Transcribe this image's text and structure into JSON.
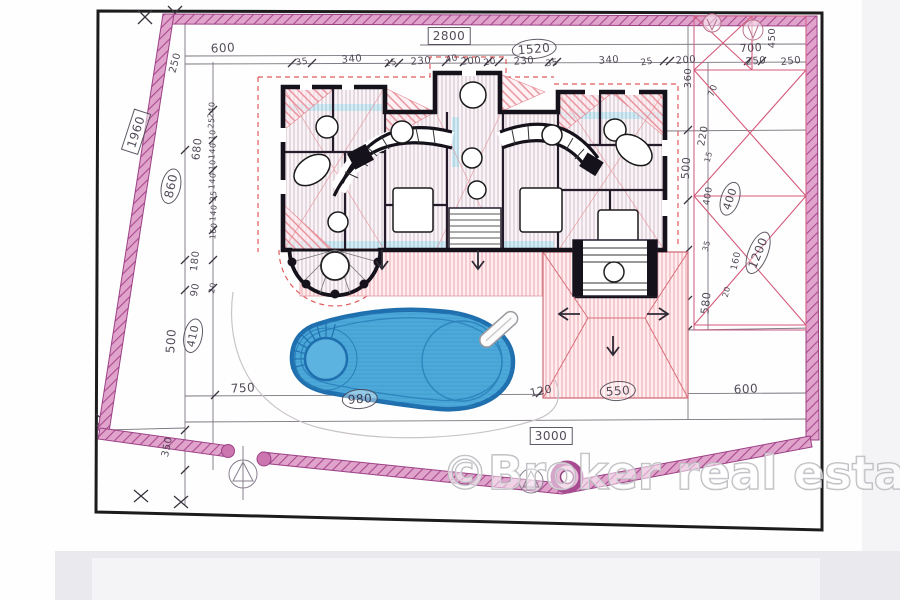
{
  "watermark": {
    "text": "©Broker real estate"
  },
  "colors": {
    "boundary_pink": "#b05898",
    "boundary_fill": "#e2a6cd",
    "pool_blue": "#4da9da",
    "pool_edge": "#1f6fae",
    "roof_red": "#e8909a",
    "wall_black": "#16121c",
    "pencil": "#4a4350",
    "paper": "#ffffff",
    "footer_gray": "#e9e9ee"
  },
  "plan": {
    "symbols": [
      "survey-marker",
      "well-ring",
      "gate-posts",
      "pergola-cross-bracing",
      "pool-ladder",
      "spa-steps",
      "direction-arrows",
      "entrance-stairs",
      "rotunda-terrace"
    ],
    "labels": [
      {
        "text": "600",
        "x": 223,
        "y": 48,
        "rot": -3,
        "size": 12
      },
      {
        "text": "2800",
        "x": 449,
        "y": 36,
        "rot": 0,
        "deco": "box",
        "size": 12
      },
      {
        "text": "1520",
        "x": 534,
        "y": 49,
        "rot": -5,
        "deco": "circle",
        "size": 12
      },
      {
        "text": "35",
        "x": 302,
        "y": 63,
        "rot": -8,
        "size": 9
      },
      {
        "text": "340",
        "x": 352,
        "y": 60,
        "rot": -5,
        "size": 10
      },
      {
        "text": "25",
        "x": 391,
        "y": 64,
        "rot": -10,
        "size": 9
      },
      {
        "text": "230",
        "x": 421,
        "y": 62,
        "rot": -5,
        "size": 10
      },
      {
        "text": "40",
        "x": 452,
        "y": 60,
        "rot": -12,
        "size": 9
      },
      {
        "text": "200",
        "x": 471,
        "y": 62,
        "rot": -5,
        "size": 10
      },
      {
        "text": "20",
        "x": 490,
        "y": 63,
        "rot": -10,
        "size": 9
      },
      {
        "text": "230",
        "x": 524,
        "y": 62,
        "rot": -4,
        "size": 10
      },
      {
        "text": "35",
        "x": 552,
        "y": 64,
        "rot": -8,
        "size": 9
      },
      {
        "text": "340",
        "x": 609,
        "y": 61,
        "rot": -4,
        "size": 10
      },
      {
        "text": "25",
        "x": 647,
        "y": 63,
        "rot": -10,
        "size": 9
      },
      {
        "text": "200",
        "x": 686,
        "y": 61,
        "rot": -4,
        "size": 10
      },
      {
        "text": "250",
        "x": 756,
        "y": 62,
        "rot": -4,
        "size": 10
      },
      {
        "text": "250",
        "x": 791,
        "y": 62,
        "rot": -6,
        "size": 10
      },
      {
        "text": "700",
        "x": 751,
        "y": 48,
        "rot": -3,
        "size": 11
      },
      {
        "text": "450",
        "x": 773,
        "y": 38,
        "rot": -90,
        "size": 10
      },
      {
        "text": "250",
        "x": 176,
        "y": 63,
        "rot": -75,
        "size": 10
      },
      {
        "text": "1960",
        "x": 136,
        "y": 132,
        "rot": -72,
        "deco": "box",
        "size": 12
      },
      {
        "text": "680",
        "x": 197,
        "y": 149,
        "rot": -84,
        "size": 11
      },
      {
        "text": "860",
        "x": 171,
        "y": 186,
        "rot": -78,
        "deco": "circle",
        "size": 12
      },
      {
        "text": "240",
        "x": 212,
        "y": 110,
        "rot": -84,
        "size": 8
      },
      {
        "text": "25",
        "x": 212,
        "y": 123,
        "rot": -84,
        "size": 8
      },
      {
        "text": "10",
        "x": 213,
        "y": 135,
        "rot": -84,
        "size": 8
      },
      {
        "text": "140",
        "x": 213,
        "y": 151,
        "rot": -84,
        "size": 8
      },
      {
        "text": "10",
        "x": 213,
        "y": 165,
        "rot": -84,
        "size": 8
      },
      {
        "text": "140",
        "x": 213,
        "y": 181,
        "rot": -84,
        "size": 8
      },
      {
        "text": "35",
        "x": 214,
        "y": 196,
        "rot": -84,
        "size": 8
      },
      {
        "text": "140",
        "x": 214,
        "y": 213,
        "rot": -84,
        "size": 8
      },
      {
        "text": "160",
        "x": 214,
        "y": 231,
        "rot": -84,
        "size": 8
      },
      {
        "text": "180",
        "x": 196,
        "y": 261,
        "rot": -84,
        "size": 10
      },
      {
        "text": "90",
        "x": 196,
        "y": 290,
        "rot": -80,
        "size": 10
      },
      {
        "text": "20",
        "x": 213,
        "y": 288,
        "rot": -80,
        "size": 8
      },
      {
        "text": "500",
        "x": 171,
        "y": 341,
        "rot": -86,
        "size": 12
      },
      {
        "text": "410",
        "x": 193,
        "y": 336,
        "rot": -78,
        "deco": "circle",
        "size": 11
      },
      {
        "text": "350",
        "x": 168,
        "y": 447,
        "rot": -78,
        "size": 10
      },
      {
        "text": "750",
        "x": 243,
        "y": 388,
        "rot": -3,
        "size": 12
      },
      {
        "text": "980",
        "x": 360,
        "y": 399,
        "rot": -4,
        "deco": "circle",
        "size": 12
      },
      {
        "text": "120",
        "x": 541,
        "y": 391,
        "rot": -12,
        "size": 11
      },
      {
        "text": "550",
        "x": 618,
        "y": 391,
        "rot": -4,
        "deco": "circle",
        "size": 12
      },
      {
        "text": "600",
        "x": 746,
        "y": 389,
        "rot": -3,
        "size": 12
      },
      {
        "text": "3000",
        "x": 551,
        "y": 436,
        "rot": 0,
        "deco": "box",
        "size": 12
      },
      {
        "text": "360",
        "x": 689,
        "y": 78,
        "rot": -90,
        "size": 10
      },
      {
        "text": "70",
        "x": 714,
        "y": 91,
        "rot": -70,
        "size": 9
      },
      {
        "text": "220",
        "x": 704,
        "y": 136,
        "rot": -80,
        "size": 10
      },
      {
        "text": "15",
        "x": 709,
        "y": 157,
        "rot": -75,
        "size": 8
      },
      {
        "text": "500",
        "x": 686,
        "y": 168,
        "rot": -86,
        "size": 11
      },
      {
        "text": "400",
        "x": 709,
        "y": 196,
        "rot": -80,
        "size": 9
      },
      {
        "text": "400",
        "x": 730,
        "y": 199,
        "rot": -72,
        "deco": "circle",
        "size": 11
      },
      {
        "text": "35",
        "x": 707,
        "y": 246,
        "rot": -75,
        "size": 8
      },
      {
        "text": "1200",
        "x": 758,
        "y": 253,
        "rot": -68,
        "deco": "circle",
        "size": 12
      },
      {
        "text": "160",
        "x": 737,
        "y": 261,
        "rot": -78,
        "size": 9
      },
      {
        "text": "20",
        "x": 727,
        "y": 292,
        "rot": -75,
        "size": 8
      },
      {
        "text": "580",
        "x": 706,
        "y": 303,
        "rot": -84,
        "size": 11
      }
    ]
  }
}
